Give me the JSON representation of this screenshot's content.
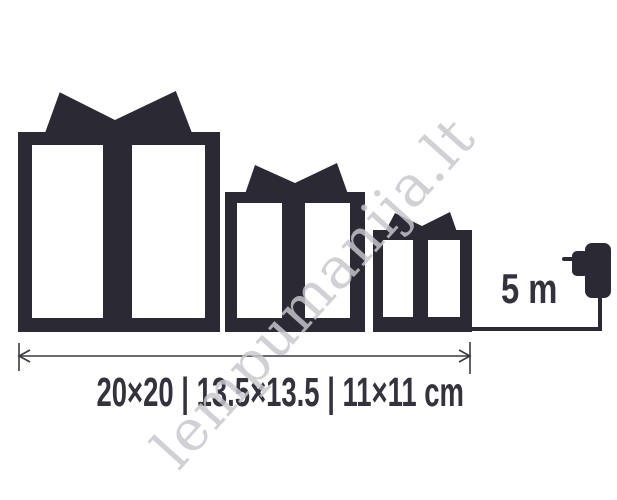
{
  "page": {
    "background_color": "#ffffff",
    "ink_color": "#2b2933"
  },
  "watermark": {
    "text": "lempumanija.lt",
    "color": "#c8c8cd"
  },
  "diagram": {
    "gift_boxes": [
      {
        "id": "large",
        "size_cm": "20×20"
      },
      {
        "id": "medium",
        "size_cm": "13.5×13.5"
      },
      {
        "id": "small",
        "size_cm": "11×11"
      }
    ],
    "cable": {
      "length_label": "5 m"
    },
    "dimensions_caption": "20×20 | 13.5×13.5 | 11×11 cm"
  }
}
